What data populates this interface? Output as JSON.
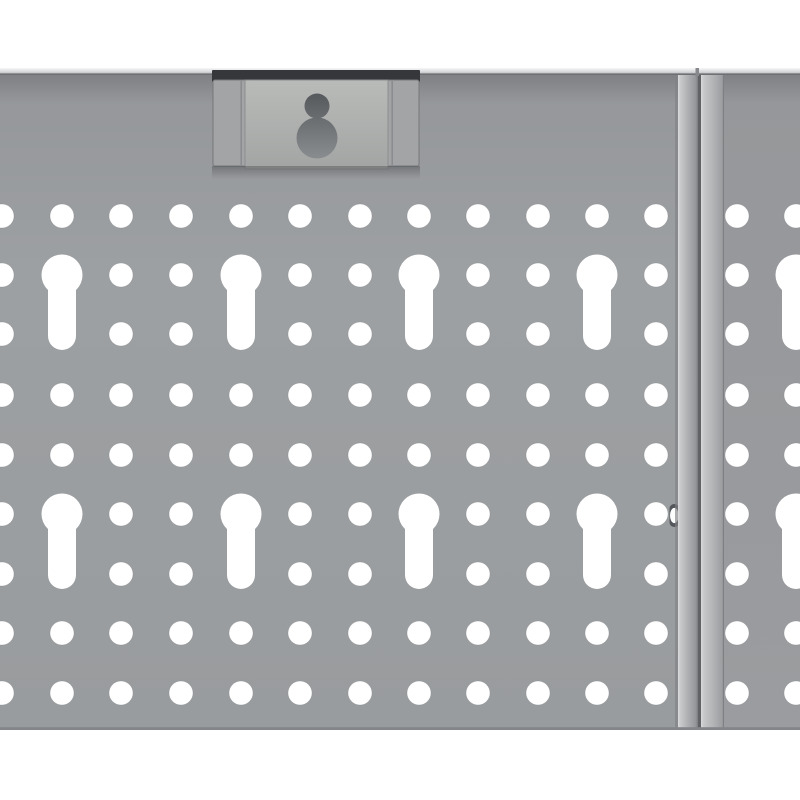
{
  "meta": {
    "description": "Close-up product photo of a light-gray perforated metal pegboard wall panel with round peg holes and keyhole hanging slots, a top wall-mount bracket with a keyhole cutout, and a vertical seam where a second matching panel joins on the right."
  },
  "canvas": {
    "width": 800,
    "height": 800,
    "background": "#ffffff"
  },
  "panel": {
    "top": 75,
    "bottom": 730,
    "face_top_color": "#94969a",
    "face_color": "#9da0a2",
    "face_bottom_color": "#999c9e",
    "face_right_color": "#95979a",
    "face_right_bottom_color": "#9a9c9f",
    "top_shadow_color": "#323436",
    "bottom_edge_color": "#83858a",
    "rim": {
      "y": 68,
      "height": 7,
      "light": "#f7f8f8",
      "mid": "#d5d7d8",
      "dark": "#a6a8ab",
      "line_color": "#6e7073",
      "notch_x": 695.5,
      "notch_width": 3.5,
      "notch_color": "#86888b"
    }
  },
  "holes": {
    "color": "#ffffff",
    "edge_color": "#7e8285",
    "radius": 12,
    "rows_y": [
      216,
      275,
      334,
      395,
      455,
      514,
      574,
      633,
      693
    ],
    "left_columns_x": [
      2,
      62,
      121,
      181,
      241,
      300,
      360,
      419,
      478,
      538,
      597,
      656
    ],
    "right_columns_x": [
      737,
      796
    ]
  },
  "keyholes": {
    "columns_x": [
      62,
      241,
      419,
      597,
      796
    ],
    "circle_rows_y": [
      275,
      514
    ],
    "circle_radius": 20.5,
    "stem_half_width": 14,
    "stem_drop": 75,
    "skip_hole_rows": [
      275,
      334,
      514,
      574
    ]
  },
  "bracket": {
    "band": {
      "x": 212,
      "y": 70,
      "width": 208,
      "height": 12,
      "color": "#35373a"
    },
    "backplate": {
      "x": 213,
      "y": 80,
      "width": 206,
      "height": 86,
      "color": "#a2a4a6",
      "edge_color": "#75777a"
    },
    "creases_x": [
      240.5,
      391.5
    ],
    "crease_color": "#85878a",
    "plate": {
      "x": 245,
      "y": 80,
      "width": 143,
      "height": 89,
      "color_top": "#b9bbb9",
      "color_bottom": "#a3a5a4",
      "edge_color": "#8c8e90"
    },
    "keyhole": {
      "cx": 317,
      "small_cy": 106,
      "small_r": 12.5,
      "big_cy": 138,
      "big_r": 20.5,
      "color_top": "#55585b",
      "color_bottom": "#8b8e90"
    },
    "shadow_color": "#1e2022"
  },
  "seam": {
    "top_y": 75,
    "bottom_y": 728,
    "panel_edge_shadow": {
      "x": 675,
      "width": 3,
      "color": "#7f8184"
    },
    "strip1": {
      "x": 678,
      "width": 20,
      "stops": [
        "#dadcdd",
        "#c9cbcd",
        "#adafb1",
        "#95979a",
        "#7b7d80"
      ]
    },
    "gap": {
      "x": 698,
      "width": 3,
      "color": "#606265"
    },
    "strip2": {
      "x": 701,
      "width": 23,
      "stops": [
        "#d8dadb",
        "#c5c7c9",
        "#aeb0b2",
        "#9b9da0",
        "#707275"
      ]
    }
  },
  "bolt": {
    "cx": 674.3,
    "cy": 515.5,
    "rx": 4.3,
    "ry": 7.6,
    "color": "#fcfdfd",
    "ring_color": "#53565a"
  }
}
